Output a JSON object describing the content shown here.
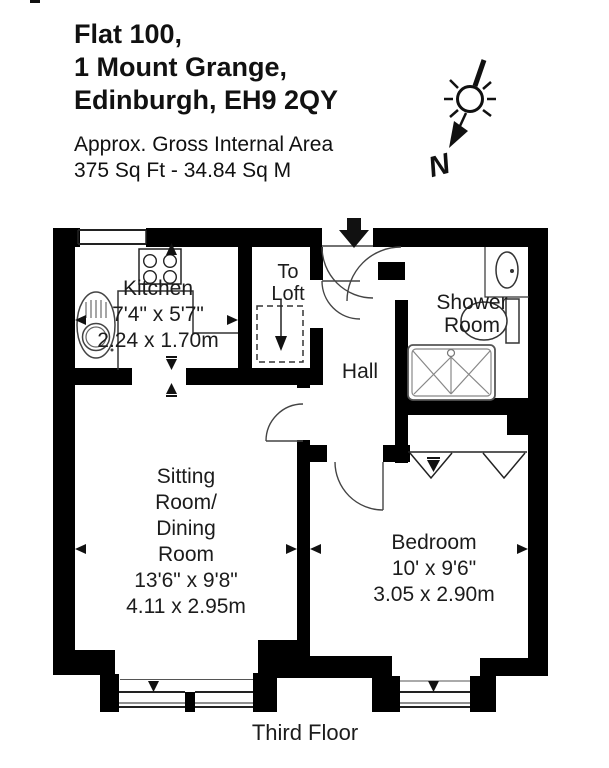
{
  "title": {
    "line1": "Flat 100,",
    "line2": "1 Mount Grange,",
    "line3": "Edinburgh, EH9 2QY"
  },
  "area": {
    "line1": "Approx. Gross Internal Area",
    "line2": "375 Sq Ft - 34.84 Sq M"
  },
  "compass": {
    "north_label": "N"
  },
  "rooms": {
    "kitchen": {
      "name": "Kitchen",
      "imperial": "7'4\" x 5'7\"",
      "metric": "2.24 x 1.70m"
    },
    "loft": {
      "line1": "To",
      "line2": "Loft"
    },
    "hall": {
      "name": "Hall"
    },
    "shower": {
      "line1": "Shower",
      "line2": "Room"
    },
    "sitting": {
      "line1": "Sitting",
      "line2": "Room/",
      "line3": "Dining",
      "line4": "Room",
      "imperial": "13'6\" x 9'8\"",
      "metric": "4.11 x 2.95m"
    },
    "bedroom": {
      "name": "Bedroom",
      "imperial": "10' x 9'6\"",
      "metric": "3.05 x 2.90m"
    }
  },
  "caption": "Third Floor",
  "icons": {
    "entrance_arrow": "solid-down-block-arrow",
    "compass": "sun-symbol-with-arrow-to-north",
    "loft_hatch": "dashed-square-with-down-arrow"
  },
  "colors": {
    "wall": "#000000",
    "line": "#444444",
    "fixture": "#555555",
    "text": "#1c1c1c",
    "background": "#ffffff"
  }
}
